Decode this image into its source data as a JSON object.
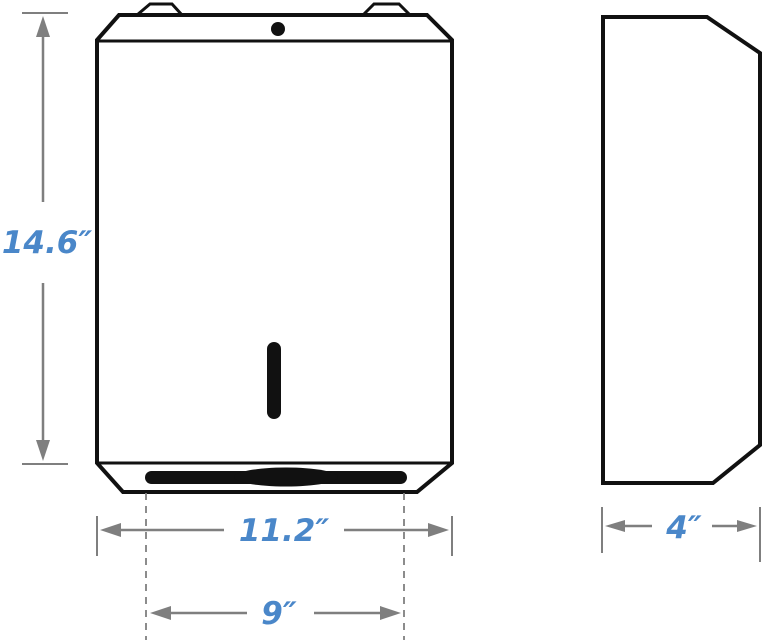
{
  "drawing": {
    "description": "Dimensioned two-view technical drawing of a wall-mounted paper towel dispenser",
    "views": {
      "front": {
        "name": "front-view"
      },
      "side": {
        "name": "side-view"
      }
    },
    "dimensions": {
      "height": {
        "label": "14.6″"
      },
      "width": {
        "label": "11.2″"
      },
      "slot_width": {
        "label": "9″"
      },
      "depth": {
        "label": "4″"
      }
    }
  },
  "colors": {
    "outline": "#111111",
    "dimension": "#7f7f7f",
    "accent": "#4a87c9",
    "background": "#ffffff"
  }
}
